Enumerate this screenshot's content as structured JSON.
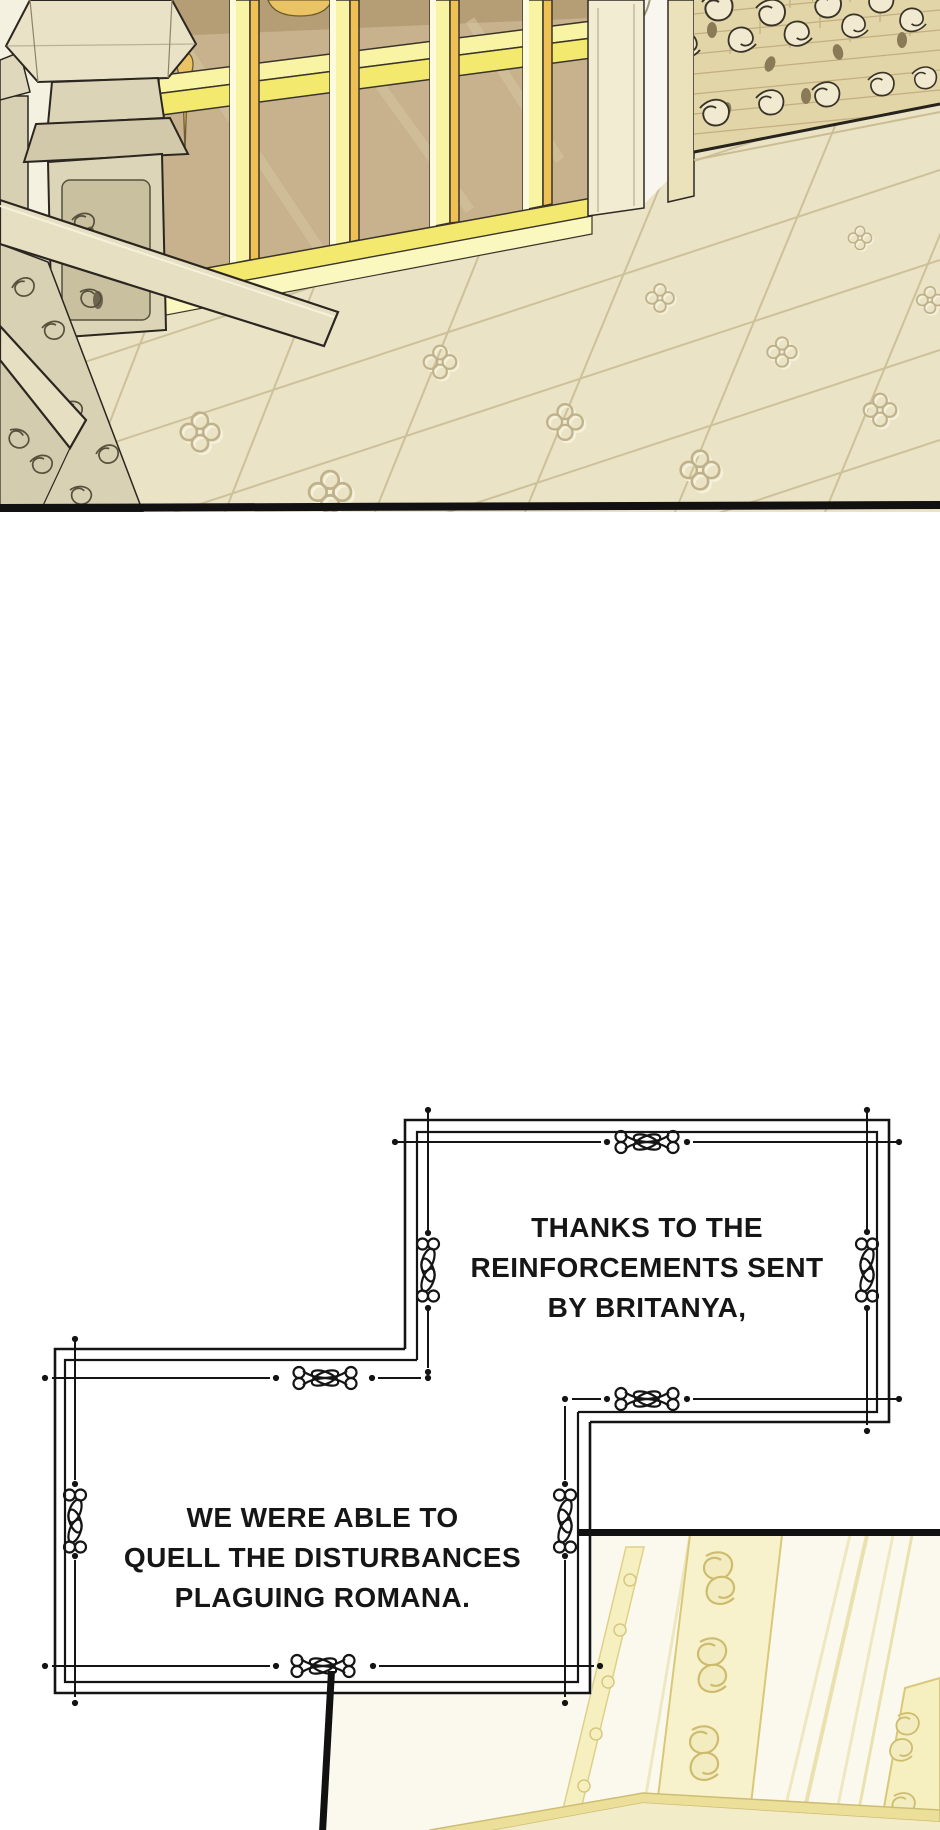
{
  "page": {
    "width": 940,
    "height": 1830,
    "background": "#ffffff",
    "kind": "webtoon comic episode segment"
  },
  "panels": {
    "top_scene": "palace interior: golden glass doors, carved gold screen, stone balustrade, embossed cream tile floor",
    "bottom_scene": "ornate ivory-and-gold door panel, partially visible at bottom right"
  },
  "narration": {
    "box1": {
      "lines": [
        "THANKS TO THE",
        "REINFORCEMENTS SENT",
        "BY BRITANYA,"
      ]
    },
    "box2": {
      "lines": [
        "WE WERE ABLE TO",
        "QUELL THE DISTURBANCES",
        "PLAGUING ROMANA."
      ]
    }
  },
  "colors": {
    "ink": "#141414",
    "frame_bright_yellow": "#f2e96e",
    "frame_pale_yellow": "#f8f4a4",
    "frame_orange": "#efc053",
    "glass_tan": "#c7b28d",
    "stone": "#ddd5b8",
    "floor": "#ebe3c6",
    "door_ivory": "#fbf9ee",
    "gold_trim": "#d9c878",
    "tassel_gold": "#eac464"
  }
}
